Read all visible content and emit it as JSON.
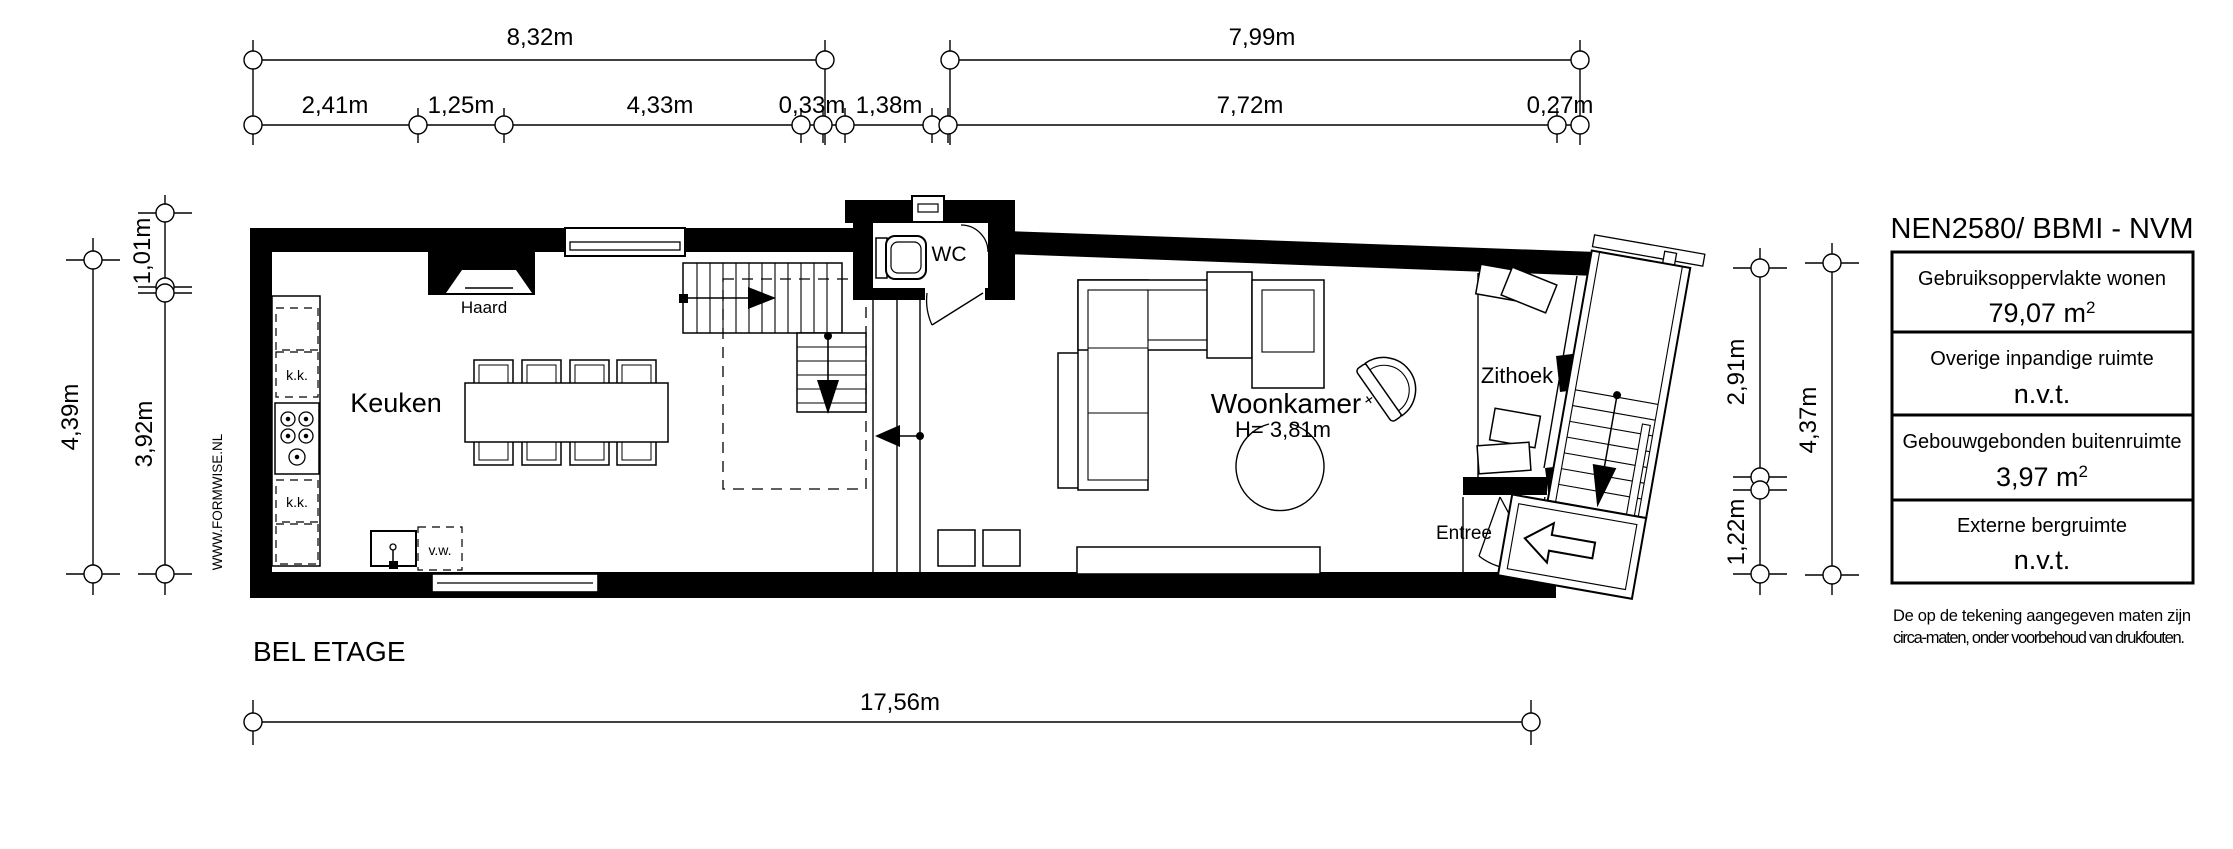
{
  "plan_title": "BEL ETAGE",
  "watermark": "WWW.FORMWISE.NL",
  "colors": {
    "ink": "#000000",
    "paper": "#ffffff"
  },
  "dims": {
    "top1": [
      "8,32m",
      "7,99m"
    ],
    "top2": [
      "2,41m",
      "1,25m",
      "4,33m",
      "0,33m",
      "1,38m",
      "7,72m",
      "0,27m"
    ],
    "left": [
      "1,01m",
      "3,92m",
      "4,39m"
    ],
    "right": [
      "2,91m",
      "1,22m",
      "4,37m"
    ],
    "bottom": "17,56m"
  },
  "rooms": {
    "keuken": "Keuken",
    "woonkamer": "Woonkamer",
    "woonkamer_height": "H= 3,81m",
    "wc": "WC",
    "zithoek": "Zithoek",
    "entree": "Entree",
    "haard": "Haard"
  },
  "kitchen": {
    "kk1": "k.k.",
    "kk2": "k.k.",
    "vw": "v.w."
  },
  "legend": {
    "title": "NEN2580/ BBMI - NVM",
    "rows": [
      {
        "label": "Gebruiksoppervlakte wonen",
        "value": "79,07 m",
        "sup": "2"
      },
      {
        "label": "Overige inpandige ruimte",
        "value": "n.v.t.",
        "sup": ""
      },
      {
        "label": "Gebouwgebonden buitenruimte",
        "value": "3,97 m",
        "sup": "2"
      },
      {
        "label": "Externe bergruimte",
        "value": "n.v.t.",
        "sup": ""
      }
    ],
    "disclaimer1": "De op de tekening aangegeven maten zijn",
    "disclaimer2": "circa-maten, onder voorbehoud van drukfouten."
  }
}
